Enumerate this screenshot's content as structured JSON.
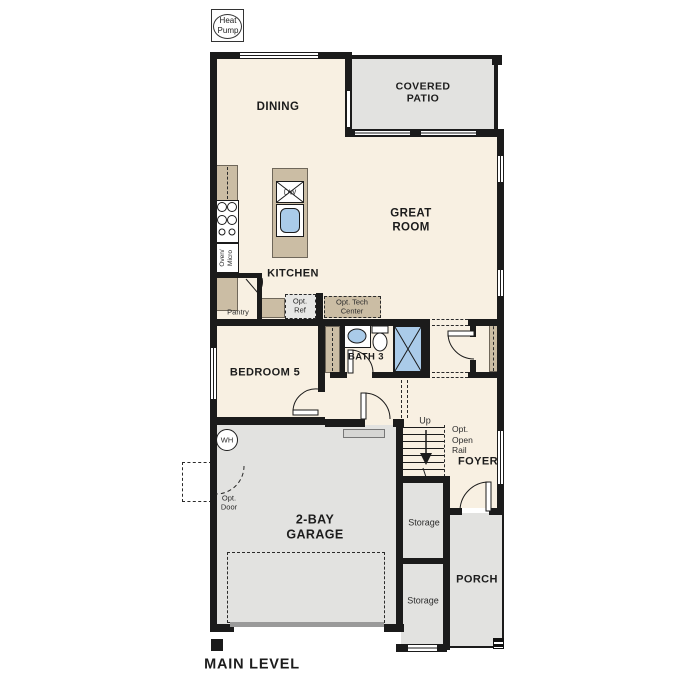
{
  "plan": {
    "title": "MAIN LEVEL",
    "heat_pump": "Heat\nPump"
  },
  "rooms": {
    "dining": "DINING",
    "covered_patio": "COVERED\nPATIO",
    "great_room": "GREAT\nROOM",
    "kitchen": "KITCHEN",
    "bedroom_5": "BEDROOM 5",
    "bath_3": "BATH 3",
    "garage": "2-BAY\nGARAGE",
    "foyer": "FOYER",
    "porch": "PORCH",
    "storage": "Storage"
  },
  "annotations": {
    "dw": "DW",
    "oven_micro": "Oven/\nMicro",
    "pantry": "Pantry",
    "opt_ref": "Opt.\nRef",
    "opt_tech_center": "Opt. Tech\nCenter",
    "wh": "WH",
    "opt_door": "Opt.\nDoor",
    "up": "Up",
    "opt_open_rail": "Opt.\nOpen\nRail"
  },
  "colors": {
    "interior_floor": "#f8f0e2",
    "exterior_floor": "#e2e2e0",
    "counter": "#cbbda4",
    "fixture_blue": "#aacbe9",
    "wall": "#1b1b1b"
  }
}
